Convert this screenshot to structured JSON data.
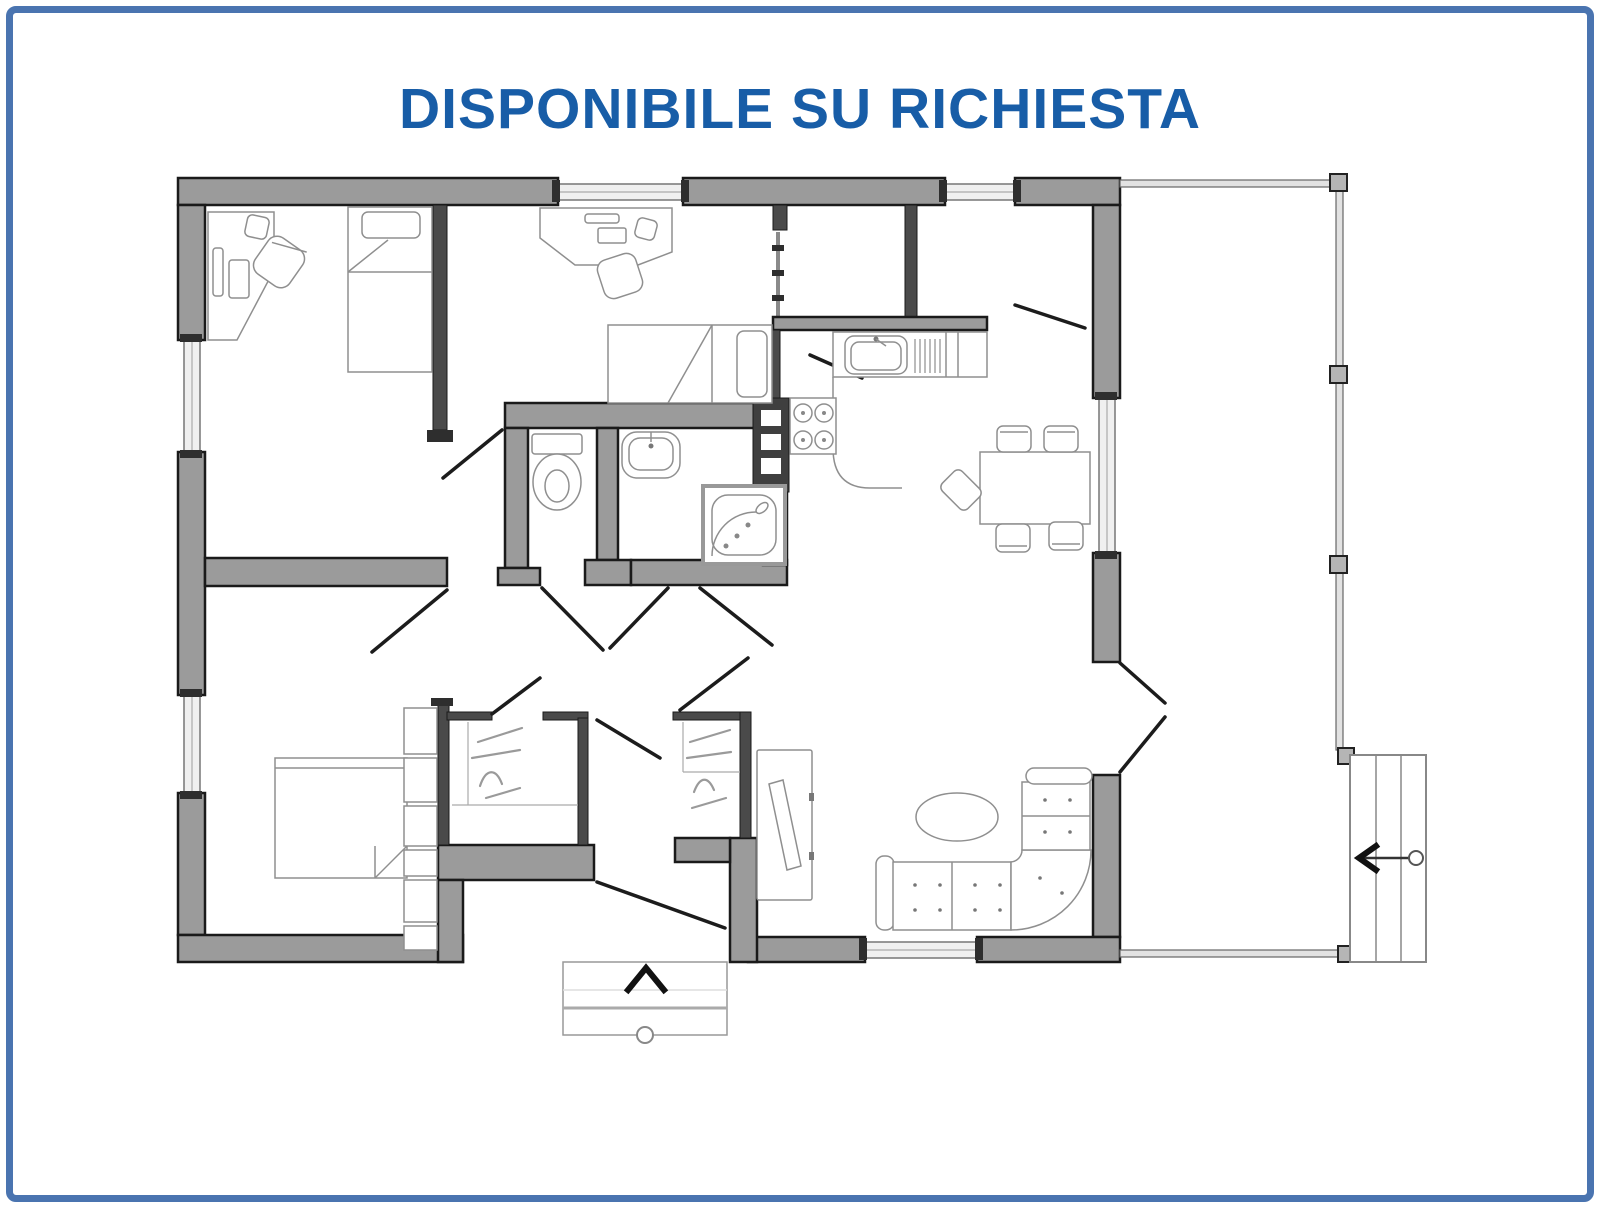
{
  "page": {
    "background": "#ffffff"
  },
  "frame": {
    "border_color": "#4a74b0",
    "border_width_px": 7,
    "border_radius_px": 10
  },
  "title": {
    "text": "DISPONIBILE SU RICHIESTA",
    "color": "#185da7"
  },
  "plan": {
    "kind": "residential-floor-plan",
    "colors": {
      "wall_fill": "#9b9b9b",
      "wall_outline": "#1a1a1a",
      "interior_wall": "#4a4a4a",
      "window_fill": "#f0f0f0",
      "furniture_line": "#8f8f8f",
      "railing": "#666666"
    },
    "annotations": {
      "entry_arrow_glyph": "^",
      "entry_arrow_direction": "up",
      "stairs_arrow_glyph": "<",
      "stairs_arrow_direction": "left"
    },
    "features": [
      "corner-desk-with-chair",
      "single-bed",
      "corner-desk-with-chair",
      "single-bed",
      "toilet",
      "washbasin",
      "shower",
      "utility-shaft",
      "kitchen-counter",
      "kitchen-sink",
      "stove-4-burners",
      "dining-table",
      "dining-chairs-5",
      "sectional-sofa",
      "coffee-table",
      "tv-cabinet",
      "double-bed",
      "closet-column",
      "walk-in-closet",
      "walk-in-closet",
      "entry-porch-steps",
      "terrace-railing",
      "external-stairs",
      "french-doors-to-terrace"
    ]
  }
}
